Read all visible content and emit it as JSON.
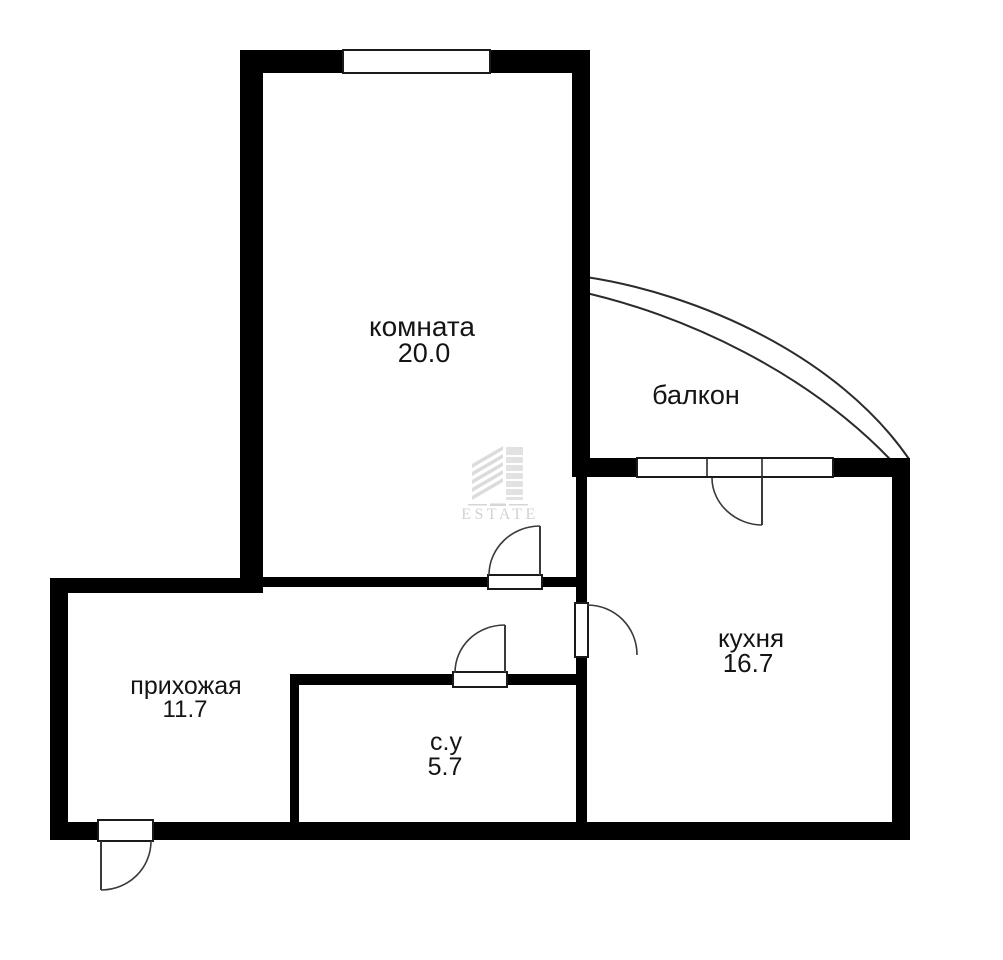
{
  "plan": {
    "rooms": {
      "living": {
        "label": "комната",
        "area": "20.0"
      },
      "balcony": {
        "label": "балкон"
      },
      "kitchen": {
        "label": "кухня",
        "area": "16.7"
      },
      "hallway": {
        "label": "прихожая",
        "area": "11.7"
      },
      "bathroom": {
        "label": "с.у",
        "area": "5.7"
      }
    },
    "watermark": {
      "brand": "ESTATE"
    },
    "colors": {
      "wall": "#000000",
      "background": "#ffffff",
      "door_line": "#3a3a3a",
      "watermark": "#d2d2d2"
    }
  }
}
